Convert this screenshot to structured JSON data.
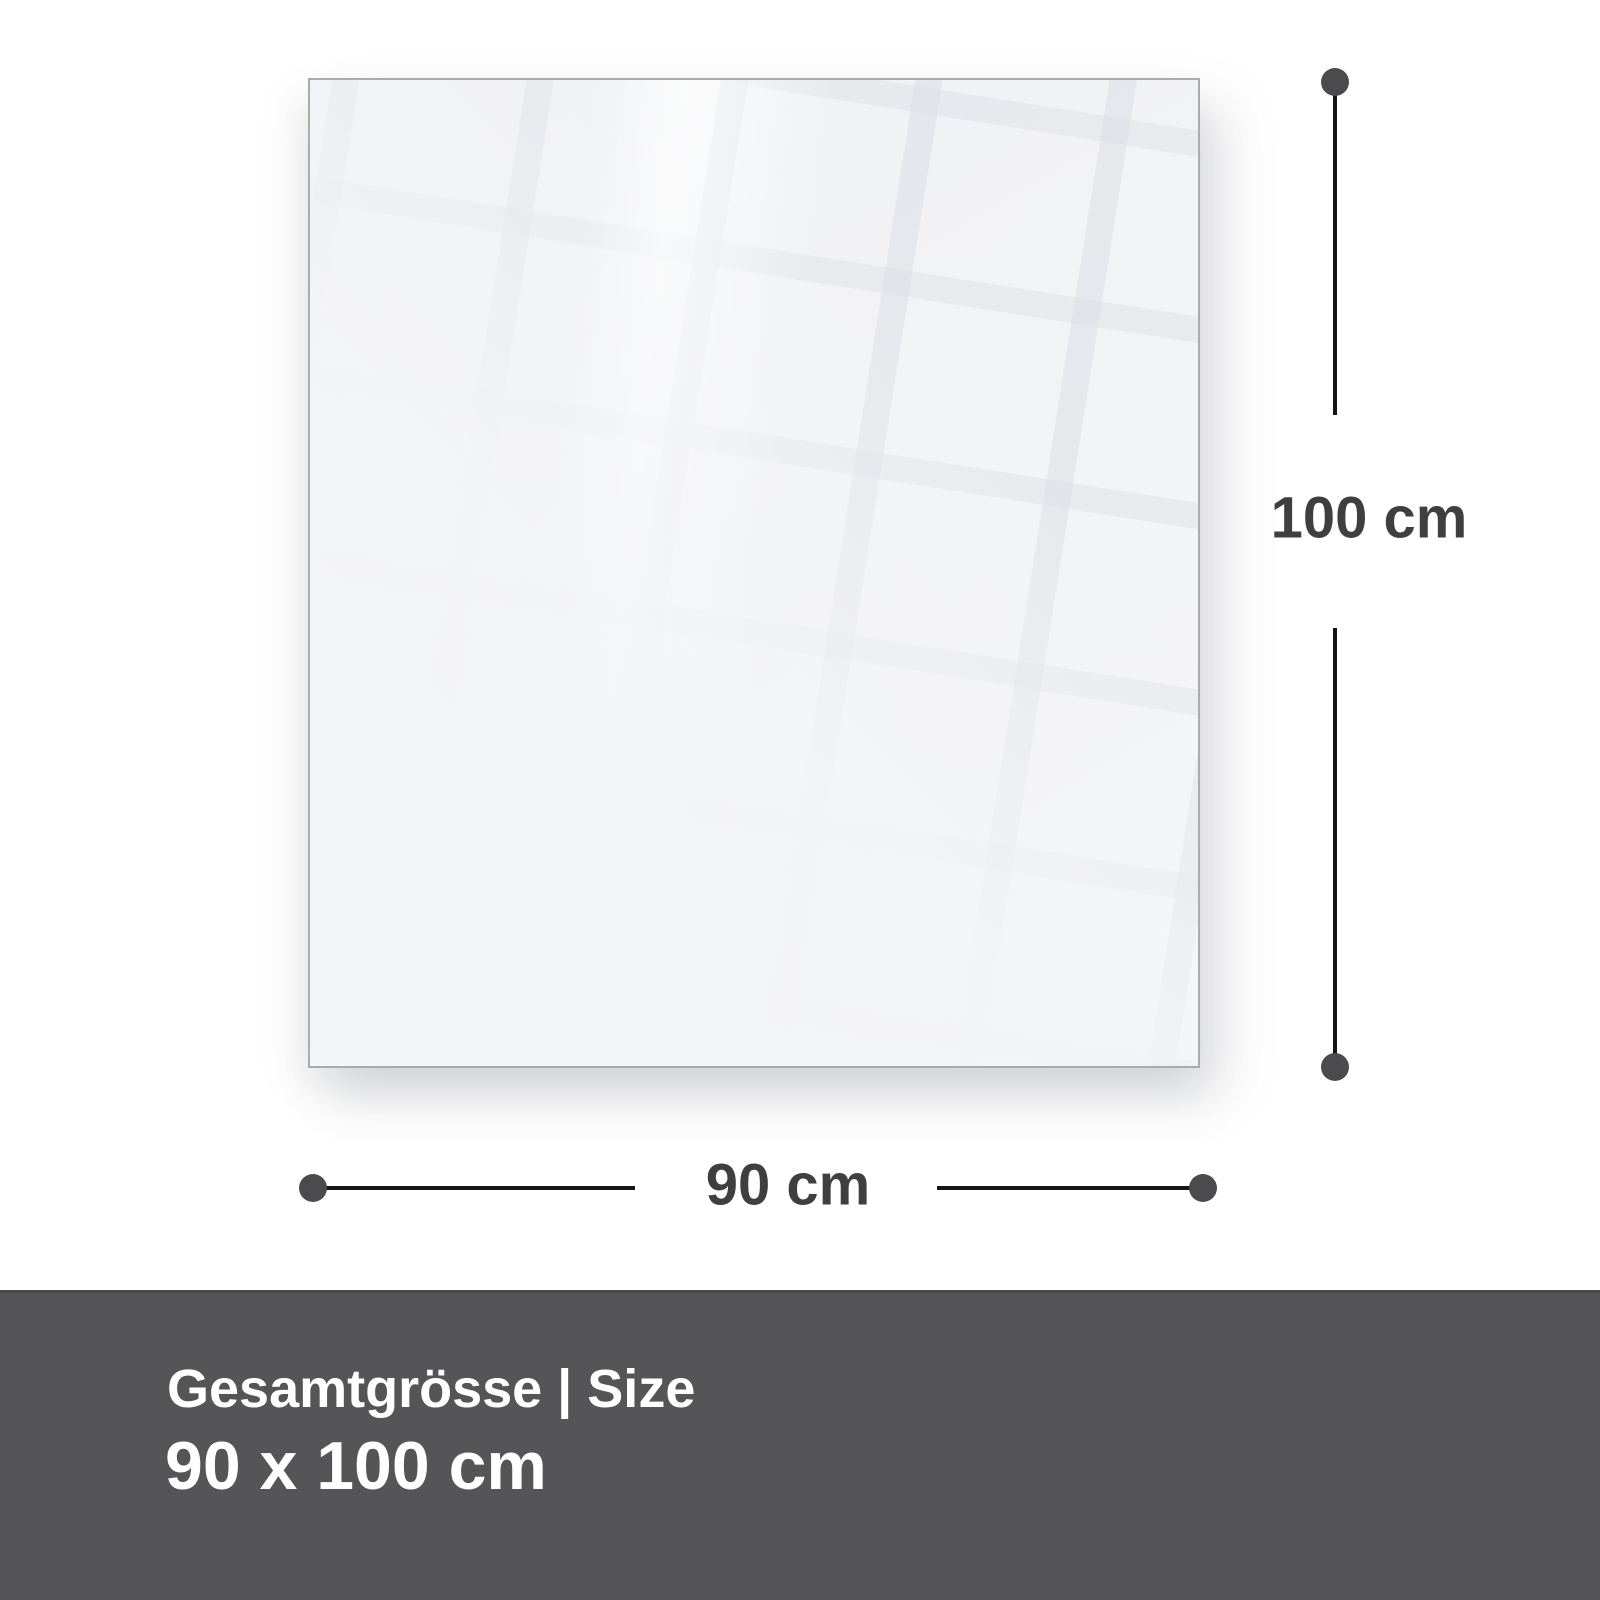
{
  "diagram": {
    "type": "product-size-diagram",
    "panel": {
      "name": "glass-panel-front-view",
      "width_cm": 90,
      "height_cm": 100
    },
    "dimensions": {
      "height_label": "100 cm",
      "width_label": "90 cm"
    }
  },
  "footer": {
    "title": "Gesamtgrösse | Size",
    "size": "90 x 100 cm"
  },
  "colors": {
    "footer_bg": "#555557",
    "footer_text": "#ffffff",
    "dimension_text": "#3f3f41",
    "line": "#161616",
    "dot": "#4b4b4d",
    "panel_fill": "#f2f3f5",
    "panel_border": "#a9abad",
    "background": "#ffffff"
  }
}
